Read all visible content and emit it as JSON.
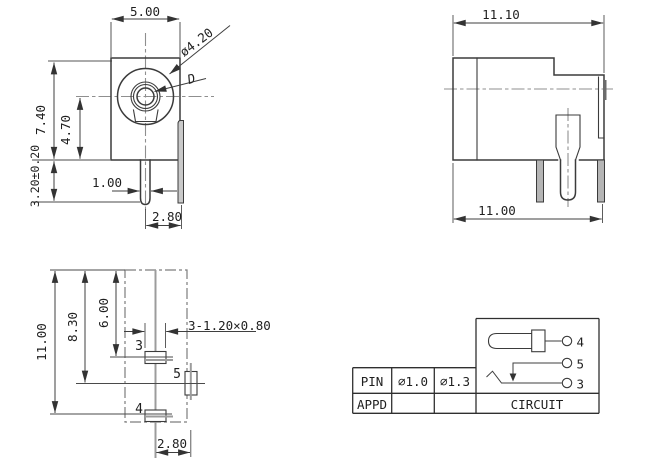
{
  "drawing": {
    "front_view": {
      "width": "5.00",
      "height": "7.40",
      "center_height": "4.70",
      "pin_length": "3.20±0.20",
      "pin_width": "1.00",
      "pin_offset": "2.80",
      "barrel_dia": "ø4.20",
      "pin_dia_label": "D"
    },
    "side_view": {
      "overall_width": "11.10",
      "body_width": "11.00"
    },
    "bottom_view": {
      "overall_length": "11.00",
      "pin5_distance": "8.30",
      "pin3_distance": "6.00",
      "slot_spec": "3-1.20×0.80",
      "pin3": "3",
      "pin5": "5",
      "pin4": "4",
      "pin5_offset": "2.80"
    },
    "table": {
      "pin_label": "PIN",
      "appd_label": "APPD",
      "pin_dia_options": [
        "∅1.0",
        "∅1.3"
      ],
      "circuit_label": "CIRCUIT",
      "circuit": {
        "pin4": "4",
        "pin5": "5",
        "pin3": "3"
      }
    },
    "colors": {
      "line": "#3b3b3b",
      "centerline": "#8f8f8f",
      "leg_fill": "#b5b5b5"
    }
  }
}
